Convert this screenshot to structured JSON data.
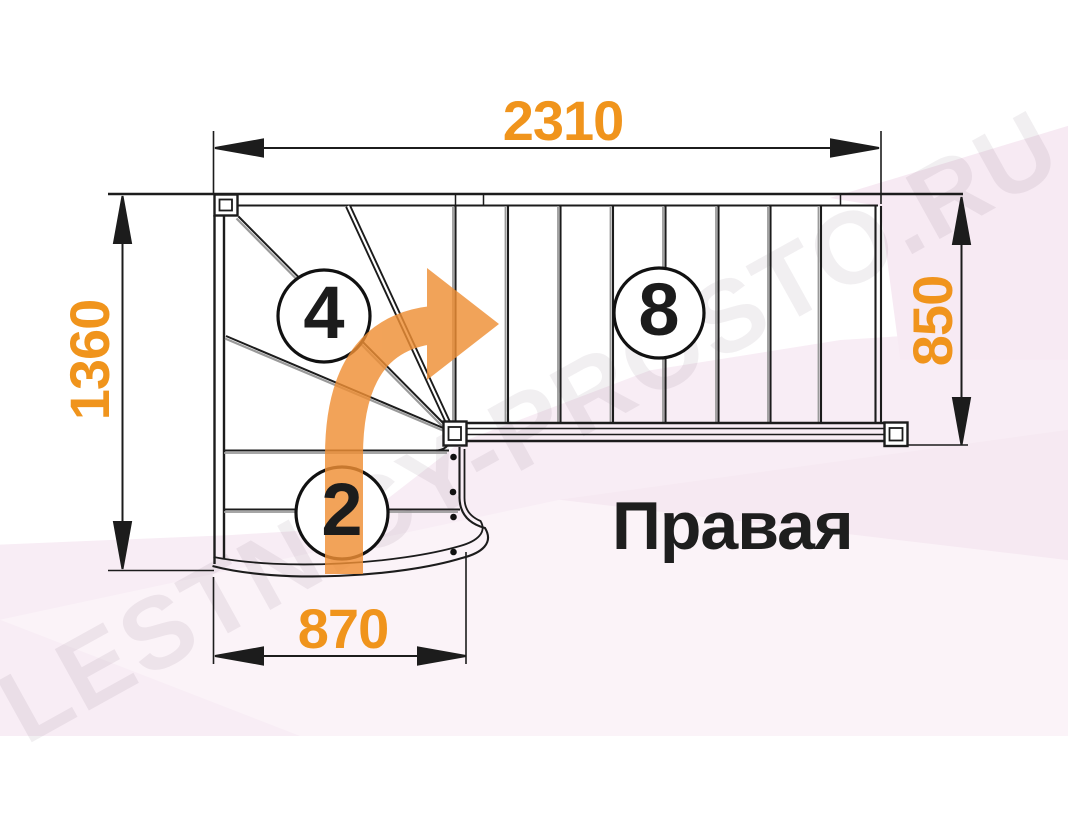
{
  "watermark": {
    "text": "LESTNICY-PROSTO.RU"
  },
  "label": {
    "text": "Правая"
  },
  "dimensions": {
    "top": "2310",
    "left": "1360",
    "right": "850",
    "bottom": "870"
  },
  "step_counts": {
    "winder": "4",
    "lower_flight": "2",
    "upper_flight": "8"
  },
  "colors": {
    "dimension_orange": "#F0941C",
    "arrow_orange": "#EF8F35",
    "line_dark": "#1C1C1C",
    "background_pink": "#F8EDF5"
  }
}
